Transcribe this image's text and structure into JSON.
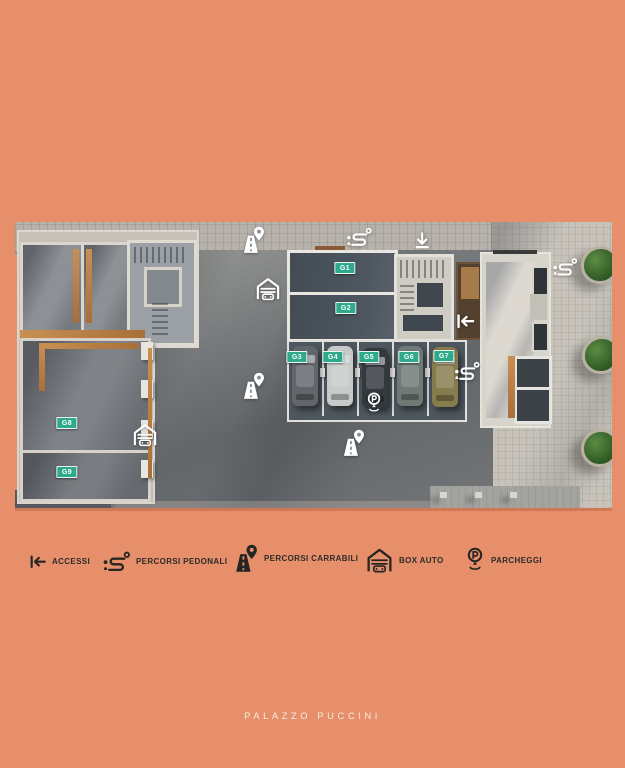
{
  "page": {
    "background_color": "#e78f6a",
    "title": "PALAZZO PUCCINI"
  },
  "legend": {
    "items": [
      {
        "icon": "access-arrow-icon",
        "label": "ACCESSI"
      },
      {
        "icon": "pedestrian-path-icon",
        "label": "PERCORSI PEDONALI"
      },
      {
        "icon": "road-pin-icon",
        "label": "PERCORSI CARRABILI"
      },
      {
        "icon": "garage-icon",
        "label": "BOX AUTO"
      },
      {
        "icon": "parking-pin-icon",
        "label": "PARCHEGGI"
      }
    ]
  },
  "plan": {
    "type": "floor-plan-top-view-render",
    "unit_label_color": "#2fa98b",
    "units": [
      {
        "label": "G1"
      },
      {
        "label": "G2"
      },
      {
        "label": "G3"
      },
      {
        "label": "G4"
      },
      {
        "label": "G5"
      },
      {
        "label": "G6"
      },
      {
        "label": "G7"
      },
      {
        "label": "G8"
      },
      {
        "label": "G9"
      }
    ],
    "map_icons": [
      {
        "type": "road-pin-icon"
      },
      {
        "type": "pedestrian-path-icon"
      },
      {
        "type": "down-arrow-icon"
      },
      {
        "type": "garage-icon"
      },
      {
        "type": "pedestrian-path-icon"
      },
      {
        "type": "access-arrow-icon"
      },
      {
        "type": "road-pin-icon"
      },
      {
        "type": "pedestrian-path-icon"
      },
      {
        "type": "parking-pin-icon"
      },
      {
        "type": "road-pin-icon"
      },
      {
        "type": "garage-icon"
      }
    ],
    "parked_cars": 5,
    "trees": 3
  }
}
